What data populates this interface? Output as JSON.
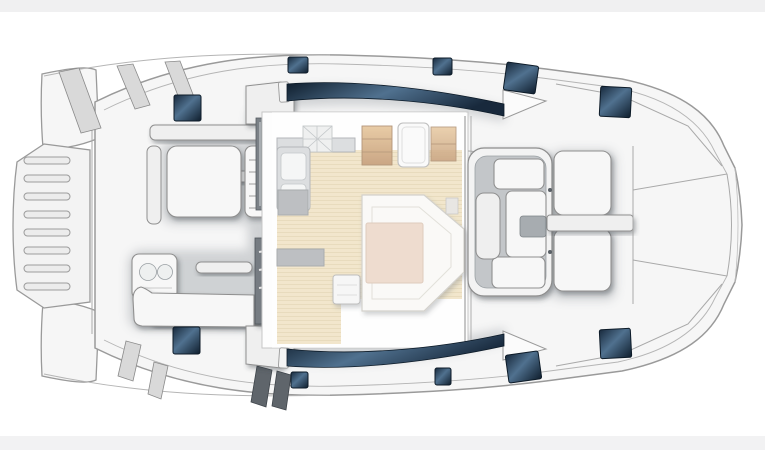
{
  "page": {
    "background": "#ffffff",
    "top_band": {
      "color": "#f0f0f1",
      "height": 12
    },
    "bottom_band": {
      "color": "#f2f2f3",
      "height": 14
    }
  },
  "diagram": {
    "kind": "catamaran-main-deck-floor-plan",
    "view": "top-down",
    "orientation": "bow-right-stern-left",
    "colors": {
      "hull_fill": "#f6f6f6",
      "hull_stroke": "#9a9a9a",
      "line_soft": "#b5b5b5",
      "line_mid": "#8d8d8d",
      "white_panel": "#f7f7f7",
      "panel_stroke": "#8f8f8f",
      "glass_dark": "#18293c",
      "glass_mid": "#50718f",
      "glass_deep": "#0f1e2d",
      "glass_stroke": "#0d1b28",
      "floor_tan": "#e8d5a7",
      "floor_line": "#d8c28e",
      "table_salmon": "#e2c3ad",
      "table_stroke": "#c9a88f",
      "wood_light": "#d8a766",
      "wood_dark": "#a4662c",
      "wood_stroke": "#7c4a1a",
      "counter_gray": "#c3c7ca",
      "counter_dark": "#8d9297",
      "steps_dark": "#767c82",
      "settee_stroke": "#b3b0a8"
    },
    "deck_hatches": [
      {
        "id": "aft-port",
        "x": 174,
        "y": 95,
        "w": 27,
        "h": 26,
        "rot": 0
      },
      {
        "id": "sidedeck-port-1",
        "x": 288,
        "y": 57,
        "w": 20,
        "h": 16,
        "rot": 0
      },
      {
        "id": "sidedeck-port-2",
        "x": 433,
        "y": 58,
        "w": 19,
        "h": 17,
        "rot": 0
      },
      {
        "id": "foredeck-port-1",
        "x": 505,
        "y": 64,
        "w": 32,
        "h": 28,
        "rot": 8
      },
      {
        "id": "foredeck-port-2",
        "x": 600,
        "y": 87,
        "w": 31,
        "h": 30,
        "rot": 3
      },
      {
        "id": "aft-stbd",
        "x": 173,
        "y": 327,
        "w": 27,
        "h": 27,
        "rot": 0
      },
      {
        "id": "sidedeck-stbd-1",
        "x": 291,
        "y": 372,
        "w": 17,
        "h": 16,
        "rot": 0
      },
      {
        "id": "sidedeck-stbd-2",
        "x": 435,
        "y": 368,
        "w": 16,
        "h": 17,
        "rot": 0
      },
      {
        "id": "foredeck-stbd-1",
        "x": 507,
        "y": 353,
        "w": 33,
        "h": 28,
        "rot": -8
      },
      {
        "id": "foredeck-stbd-2",
        "x": 600,
        "y": 329,
        "w": 31,
        "h": 29,
        "rot": -3
      }
    ],
    "swim_platform_slats": [
      {
        "x": 24,
        "y": 157,
        "w": 46,
        "h": 7
      },
      {
        "x": 24,
        "y": 175,
        "w": 46,
        "h": 7
      },
      {
        "x": 24,
        "y": 193,
        "w": 46,
        "h": 7
      },
      {
        "x": 24,
        "y": 211,
        "w": 46,
        "h": 7
      },
      {
        "x": 24,
        "y": 229,
        "w": 46,
        "h": 7
      },
      {
        "x": 24,
        "y": 247,
        "w": 46,
        "h": 7
      },
      {
        "x": 24,
        "y": 265,
        "w": 46,
        "h": 7
      },
      {
        "x": 24,
        "y": 283,
        "w": 46,
        "h": 7
      }
    ],
    "aft_bench": {
      "slat_ys": [
        160,
        172,
        184,
        196,
        208
      ],
      "x1": 249,
      "x2": 268
    }
  }
}
